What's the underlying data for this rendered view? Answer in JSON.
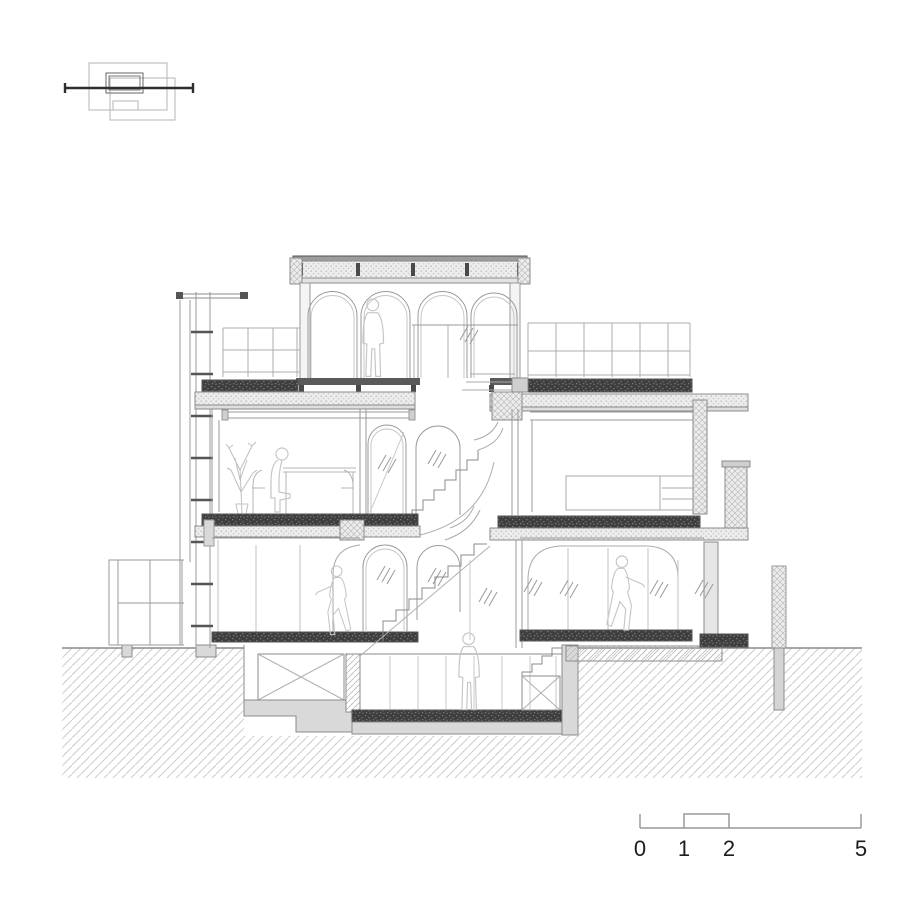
{
  "drawing": {
    "kind": "architectural cross-section",
    "scale_bar": {
      "labels": [
        "0",
        "1",
        "2",
        "5"
      ]
    },
    "colors": {
      "background": "#ffffff",
      "linework": "#8b8b8b",
      "light_linework": "#b8b8b8",
      "dark_fill": "#3f3f3f",
      "concrete_fill": "#d9d9d9",
      "hatch_line": "#c9c9c9",
      "figure_line": "#c6c6c6",
      "section_line": "#2e2e2e",
      "label_text": "#1c1c1c"
    }
  }
}
